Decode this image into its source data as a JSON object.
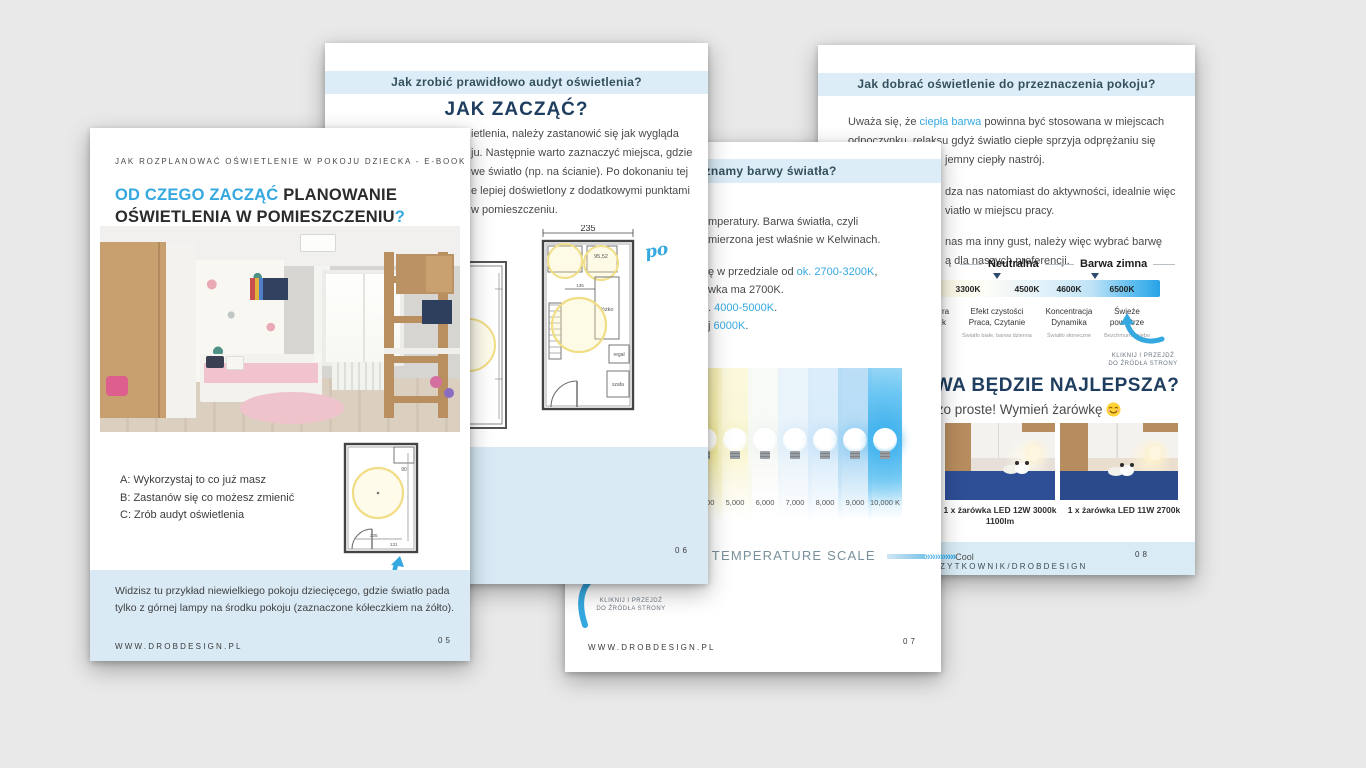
{
  "canvas": {
    "background": "#e9e9e9",
    "accent": "#35a8e0",
    "navy": "#1e3d5f",
    "band_bg": "#dcedf7"
  },
  "page05": {
    "kicker": "JAK ROZPLANOWAĆ OŚWIETLENIE W POKOJU DZIECKA - E-BOOK",
    "title_accent": "OD CZEGO ZACZĄĆ ",
    "title_rest": "PLANOWANIE",
    "title_line2": "OŚWIETLENIA W POMIESZCZENIU",
    "title_qmark": "?",
    "options": [
      "A: Wykorzystaj to co już masz",
      "B: Zastanów się co możesz zmienić",
      "C: Zrób audyt oświetlenia"
    ],
    "note_line1": "Widzisz tu przykład niewielkiego pokoju dziecięcego, gdzie światło pada",
    "note_line2": "tylko z górnej lampy na środku pokoju (zaznaczone kółeczkiem na żółto).",
    "footer": "WWW.DROBDESIGN.PL",
    "page_number": "05"
  },
  "page06": {
    "band": "Jak zrobić prawidłowo audyt oświetlenia?",
    "title": "JAK ZACZĄĆ?",
    "para": [
      "ietlenia, należy zastanowić się jak wygląda",
      "ju. Następnie warto zaznaczyć miejsca, gdzie",
      "we światło (np. na ścianie). Po dokonaniu tej",
      "e lepiej doświetlony z dodatkowymi punktami",
      "w pomieszczeniu."
    ],
    "dim_label": "235",
    "annotation": "po",
    "plan_labels": {
      "a": "95,52",
      "b": "łóżko",
      "c": "regał",
      "d": "szafa"
    },
    "page_number": "06"
  },
  "page07": {
    "band": "Jakie znamy barwy światła?",
    "l1": "mperatury. Barwa światła, czyli",
    "l2": "mierzona jest właśnie w Kelwinach.",
    "l3_pre": "ę w przedziale od ",
    "l3_accent": "ok. 2700-3200K",
    "l3_post": ",",
    "l4": "wka ma 2700K.",
    "l5_pre": ". ",
    "l5_accent": "4000-5000K",
    "l5_post": ".",
    "l6_pre": "j ",
    "l6_accent": "6000K",
    "l6_post": ".",
    "scale_labels": [
      "4,000",
      "5,000",
      "6,000",
      "7,000",
      "8,000",
      "9,000",
      "10,000 K"
    ],
    "scale_title": "COLOR TEMPERATURE SCALE",
    "scale_arrows": "»»»",
    "scale_cool": "Cool",
    "click_note_l1": "KLIKNIJ I PRZEJDŹ",
    "click_note_l2": "DO ŹRÓDŁA STRONY",
    "footer": "WWW.DROBDESIGN.PL",
    "page_number": "07"
  },
  "page08": {
    "band": "Jak dobrać oświetlenie do przeznaczenia pokoju?",
    "p1_pre": "Uważa się, że ",
    "p1_accent": "ciepła barwa",
    "p1_post": " powinna być stosowana w miejscach",
    "p1_l2": "odpoczynku, relaksu gdyż światło ciepłe sprzyja odprężaniu się",
    "p1_l3": "jemny ciepły nastrój.",
    "p2_l1": "dza nas natomiast do aktywności, idealnie więc",
    "p2_l2": "viatło w miejscu pracy.",
    "p3_l1": "nas ma inny gust, należy więc wybrać barwę",
    "p3_l2": "ą dla naszych preferencji.",
    "chart": {
      "group1": "Neutralna",
      "group2": "Barwa zimna",
      "kelvins": [
        "3300K",
        "4500K",
        "4600K",
        "6500K"
      ],
      "col1_frag_l1": "ra",
      "col1_frag_l2": "k",
      "col2_l1": "Efekt czystości",
      "col2_l2": "Praca, Czytanie",
      "col3_l1": "Koncentracja",
      "col3_l2": "Dynamika",
      "col4_l1": "Świeże",
      "col4_l2": "powietrze",
      "cap2": "Światło białe, barwa dzienna",
      "cap3": "Światło słoneczne",
      "cap4": "Bezchmurne niebo"
    },
    "click_note_l1": "KLIKNIJ I PRZEJDŹ",
    "click_note_l2": "DO ŹRÓDŁA STRONY",
    "headline": "JAKA BARWA BĘDZIE NAJLEPSZA?",
    "subline": "To bardzo proste! Wymień żarówkę",
    "photo1_caption_l1": "1 x żarówka LED 12W 3000k",
    "photo1_caption_l2": "1100lm",
    "photo2_caption": "1 x żarówka LED 11W 2700k",
    "footer": "UZYTKOWNIK/DROBDESIGN",
    "page_number": "08"
  }
}
